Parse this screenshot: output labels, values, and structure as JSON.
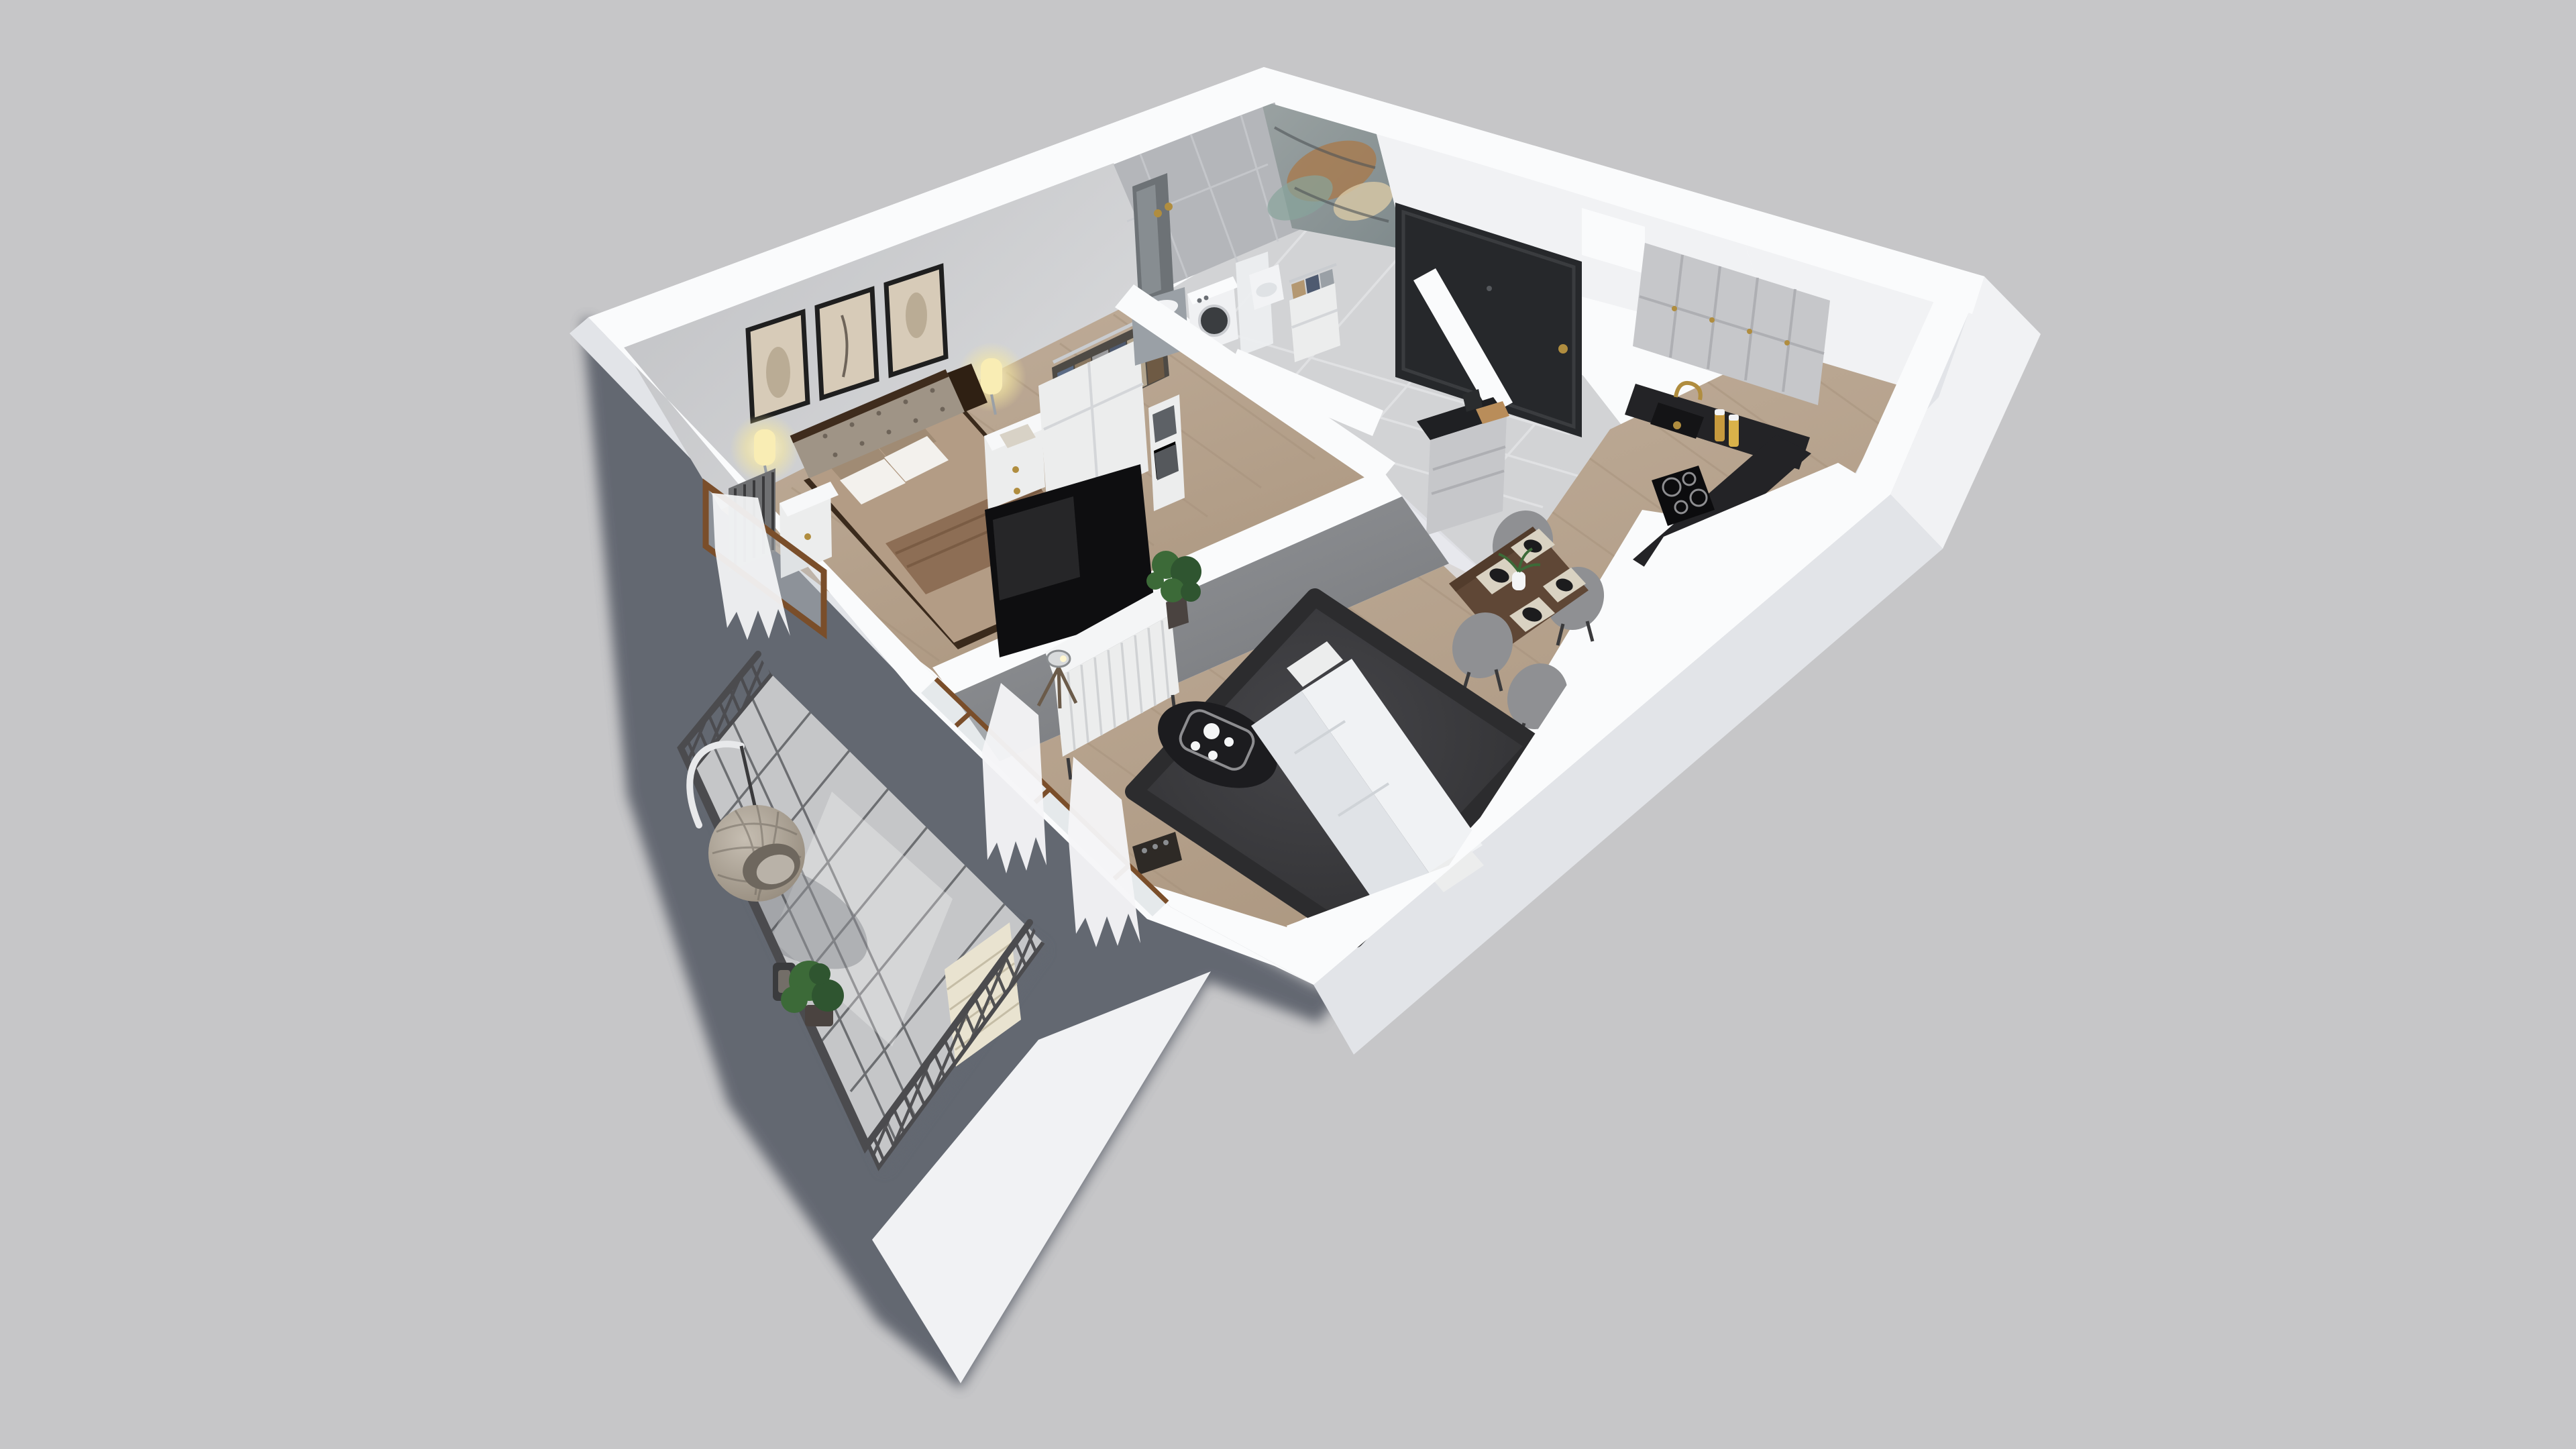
{
  "scene": {
    "type": "3d-floor-plan-cutaway-render",
    "view": "axonometric top-down, rotated, on plain studio background with cast shadow",
    "rooms": [
      {
        "name": "bedroom",
        "items": [
          "double-bed",
          "tufted-headboard",
          "white-pillows",
          "taupe-pillows",
          "brown-blanket",
          "nightstand-left",
          "nightstand-right",
          "radiator",
          "wall-art-frame-1",
          "wall-art-frame-2",
          "wall-art-frame-3",
          "wall-sconce-left",
          "wall-sconce-right",
          "open-wardrobe-with-hanging-clothes",
          "storage-shelf-with-boxes",
          "window-with-curtain"
        ]
      },
      {
        "name": "bathroom",
        "items": [
          "tall-mirror",
          "gold-sconces",
          "vanity-sink",
          "washing-machine",
          "marble-accent-wall",
          "shower-panel",
          "toilet"
        ]
      },
      {
        "name": "hallway",
        "items": [
          "entrance-door",
          "coat-cabinet-with-clothes",
          "wall-niche",
          "tile-floor"
        ]
      },
      {
        "name": "kitchen",
        "items": [
          "upper-cabinets",
          "black-countertop",
          "black-sink",
          "gold-faucet",
          "induction-cooktop",
          "spice-jars",
          "island-cabinet",
          "cutting-board",
          "knife-block",
          "dining-table",
          "dining-chairs",
          "place-settings",
          "vase-with-plant"
        ]
      },
      {
        "name": "living-room",
        "items": [
          "concrete-tv-wall",
          "tv",
          "fluted-tv-stand",
          "tripod-lamp",
          "monstera-plant",
          "charcoal-rug",
          "black-coffee-table",
          "tea-set-tray",
          "corner-sofa",
          "bottle-rack",
          "sheer-curtains",
          "balcony-glass-doors"
        ]
      },
      {
        "name": "balcony",
        "items": [
          "tile-floor-grid",
          "metal-lattice-railing",
          "hanging-egg-chair",
          "potted-plant",
          "lantern",
          "brick-wall-section"
        ]
      }
    ],
    "counts": {
      "wall_art_frames": 3,
      "dining_chairs": 4,
      "place_settings": 4,
      "tea_cups": 3,
      "upper_cabinet_doors": 5,
      "bedroom_sconces": 2
    }
  },
  "colors": {
    "bg": "#c6c6c8",
    "shadow": "#575c66",
    "wallTop": "#fafbfc",
    "wallFace": "#f1f2f4",
    "wallShade": "#e2e4e8",
    "bedroomWallLight": "#d6d7d9",
    "bedroomWallDark": "#bfc0c3",
    "tileWall": "#b4b6ba",
    "tileFloor": "#d2d3d5",
    "balconyTile": "#c5c6c8",
    "grout": "#56585c",
    "woodLight": "#c3b19e",
    "woodDark": "#ab967f",
    "railing": "#4b4b4e",
    "rug": "#353537",
    "sofa": "#f0f2f4",
    "sofaShade": "#e0e3e7",
    "counterBlack": "#232326",
    "cabinetGray": "#c6c7ca",
    "doorDark": "#26282b",
    "gold": "#b08d3f",
    "tableWood": "#5f4736",
    "chairGray": "#8f9093",
    "furnWhite": "#eceded",
    "tvBlack": "#0e0e10",
    "green": "#3c6a38",
    "greenDark": "#2f5530",
    "brickCream": "#e9e3d0",
    "curtain": "#f5f6f8",
    "bedding": "#b39c85",
    "blanket": "#8d6e55",
    "headboard": "#9f9486",
    "pillow": "#f3f1ed",
    "pillowTaupe": "#a08b74",
    "frameBlack": "#1f1f1f",
    "artBeige": "#d7cbb8",
    "rattan": "#b3aa9d",
    "concreteLight": "#97999c",
    "concreteDark": "#74767a",
    "marbleBase": "#9aa2a2",
    "marbleRust": "#a97848",
    "marbleTeal": "#87a49b",
    "marbleCream": "#d9c9a6",
    "woodFrame": "#7a4e2a",
    "glow": "#f6e8a0"
  }
}
